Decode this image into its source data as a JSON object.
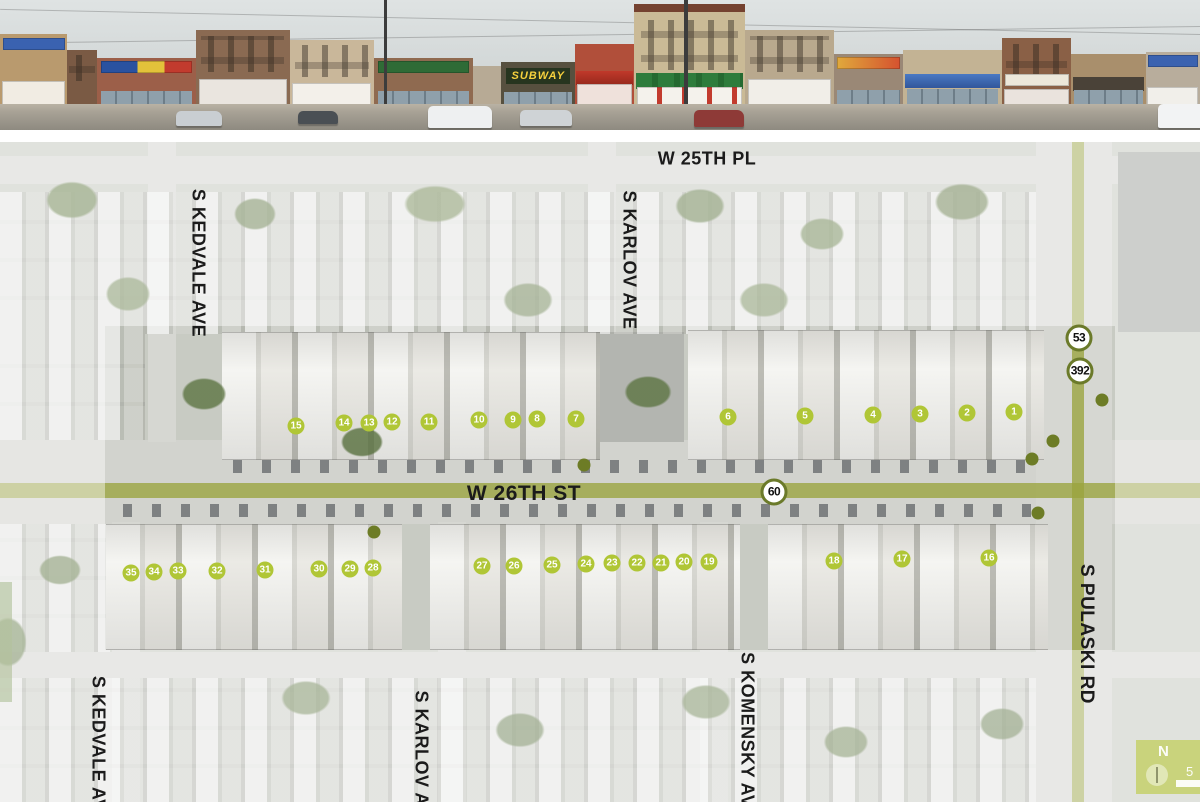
{
  "panorama": {
    "subway_sign": "SUBWAY"
  },
  "map": {
    "street_labels": [
      {
        "text": "W 25TH PL",
        "x": 707,
        "y": 17,
        "rotate": 0,
        "size": 18
      },
      {
        "text": "S KARLOV AVE",
        "x": 629,
        "y": 118,
        "rotate": 90,
        "size": 18
      },
      {
        "text": "S KEDVALE AVE",
        "x": 198,
        "y": 121,
        "rotate": 90,
        "size": 18
      },
      {
        "text": "W 26TH ST",
        "x": 524,
        "y": 352,
        "rotate": 0,
        "size": 21
      },
      {
        "text": "S PULASKI RD",
        "x": 1086,
        "y": 492,
        "rotate": 90,
        "size": 19
      },
      {
        "text": "S KEDVALE AVE",
        "x": 98,
        "y": 608,
        "rotate": 90,
        "size": 18
      },
      {
        "text": "S KARLOV AVE",
        "x": 421,
        "y": 618,
        "rotate": 90,
        "size": 18
      },
      {
        "text": "S KOMENSKY AVE",
        "x": 747,
        "y": 594,
        "rotate": 90,
        "size": 18
      }
    ],
    "building_markers": [
      {
        "label": "1",
        "x": 1014,
        "y": 270
      },
      {
        "label": "2",
        "x": 967,
        "y": 271
      },
      {
        "label": "3",
        "x": 920,
        "y": 272
      },
      {
        "label": "4",
        "x": 873,
        "y": 273
      },
      {
        "label": "5",
        "x": 805,
        "y": 274
      },
      {
        "label": "6",
        "x": 728,
        "y": 275
      },
      {
        "label": "7",
        "x": 576,
        "y": 277
      },
      {
        "label": "8",
        "x": 537,
        "y": 277
      },
      {
        "label": "9",
        "x": 513,
        "y": 278
      },
      {
        "label": "10",
        "x": 479,
        "y": 278
      },
      {
        "label": "11",
        "x": 429,
        "y": 280
      },
      {
        "label": "12",
        "x": 392,
        "y": 280
      },
      {
        "label": "13",
        "x": 369,
        "y": 281
      },
      {
        "label": "14",
        "x": 344,
        "y": 281
      },
      {
        "label": "15",
        "x": 296,
        "y": 284
      },
      {
        "label": "16",
        "x": 989,
        "y": 416
      },
      {
        "label": "17",
        "x": 902,
        "y": 417
      },
      {
        "label": "18",
        "x": 834,
        "y": 419
      },
      {
        "label": "19",
        "x": 709,
        "y": 420
      },
      {
        "label": "20",
        "x": 684,
        "y": 420
      },
      {
        "label": "21",
        "x": 661,
        "y": 421
      },
      {
        "label": "22",
        "x": 637,
        "y": 421
      },
      {
        "label": "23",
        "x": 612,
        "y": 421
      },
      {
        "label": "24",
        "x": 586,
        "y": 422
      },
      {
        "label": "25",
        "x": 552,
        "y": 423
      },
      {
        "label": "26",
        "x": 514,
        "y": 424
      },
      {
        "label": "27",
        "x": 482,
        "y": 424
      },
      {
        "label": "28",
        "x": 373,
        "y": 426
      },
      {
        "label": "29",
        "x": 350,
        "y": 427
      },
      {
        "label": "30",
        "x": 319,
        "y": 427
      },
      {
        "label": "31",
        "x": 265,
        "y": 428
      },
      {
        "label": "32",
        "x": 217,
        "y": 429
      },
      {
        "label": "33",
        "x": 178,
        "y": 429
      },
      {
        "label": "34",
        "x": 154,
        "y": 430
      },
      {
        "label": "35",
        "x": 131,
        "y": 431
      }
    ],
    "route_badges": [
      {
        "label": "53",
        "x": 1079,
        "y": 196
      },
      {
        "label": "392",
        "x": 1080,
        "y": 229
      },
      {
        "label": "60",
        "x": 774,
        "y": 350
      }
    ],
    "poi_dots": [
      {
        "x": 584,
        "y": 323
      },
      {
        "x": 1102,
        "y": 258
      },
      {
        "x": 1053,
        "y": 299
      },
      {
        "x": 1032,
        "y": 317
      },
      {
        "x": 1038,
        "y": 371
      },
      {
        "x": 374,
        "y": 390
      }
    ],
    "north_arrow": {
      "label": "N"
    },
    "scale": {
      "number": "5"
    }
  },
  "colors": {
    "marker_green": "#b0c636",
    "dot_green": "#6d7c26",
    "badge_border_olive": "#6b7a2a",
    "route_band_olive": "#9aa43e",
    "label_black": "#1b1b1b"
  }
}
